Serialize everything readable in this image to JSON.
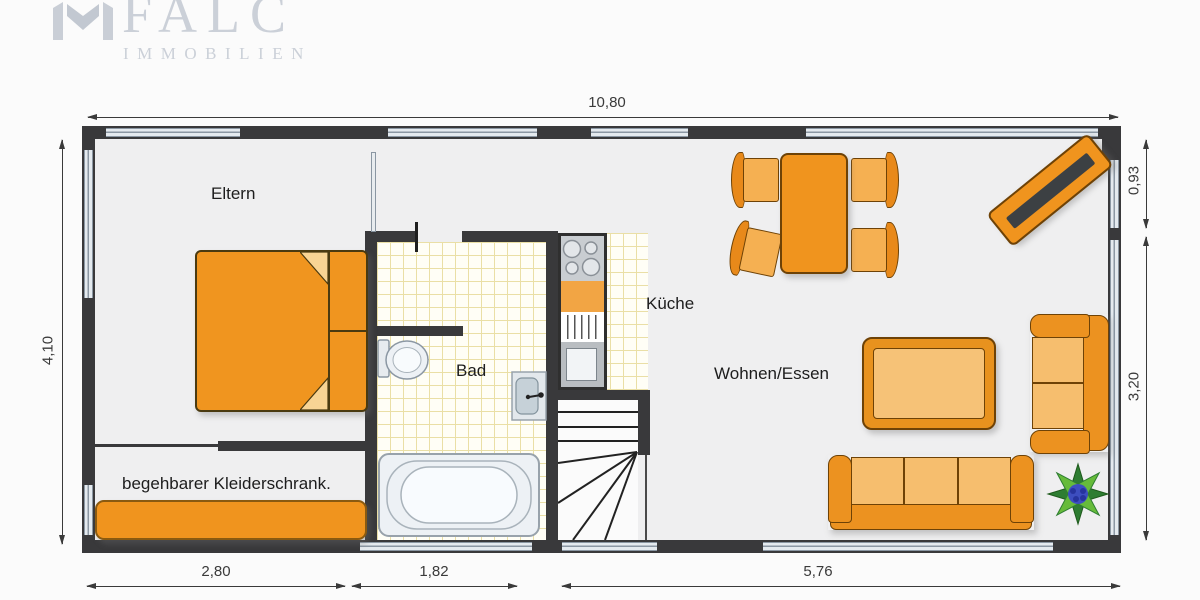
{
  "logo": {
    "brand": "FALC",
    "subtitle": "IMMOBILIEN"
  },
  "plan": {
    "room_labels": {
      "eltern": "Eltern",
      "bad": "Bad",
      "kueche": "Küche",
      "wohnen_essen": "Wohnen/Essen",
      "kleiderschrank": "begehbarer Kleiderschrank."
    },
    "dimensions": {
      "top_width": "10,80",
      "left_height": "4,10",
      "right_upper": "0,93",
      "right_lower": "3,20",
      "bottom_left": "2,80",
      "bottom_middle": "1,82",
      "bottom_right": "5,76"
    }
  },
  "icons": {
    "logo_mark": "falc-house-mark",
    "plant": "plant",
    "tv": "tv-on-sideboard"
  },
  "colors": {
    "wall": "#39393B",
    "floor": "#EFEFF0",
    "window_glass": "#E4EAEF",
    "tile_grid": "#EADFA6",
    "furniture_orange": "#F0941E",
    "furniture_light_orange": "#F6BE6E",
    "furniture_border": "#6E4206",
    "sanitary_fill": "#EDF1F5",
    "sanitary_border": "#98A2AB",
    "tv_screen": "#3C4043",
    "plant_green_dark": "#2E7D32",
    "plant_green_light": "#66BB3A",
    "plant_center_blue": "#3D4EC0",
    "logo_gray": "#CBD0D8",
    "dimension_text": "#3A3A3A"
  }
}
